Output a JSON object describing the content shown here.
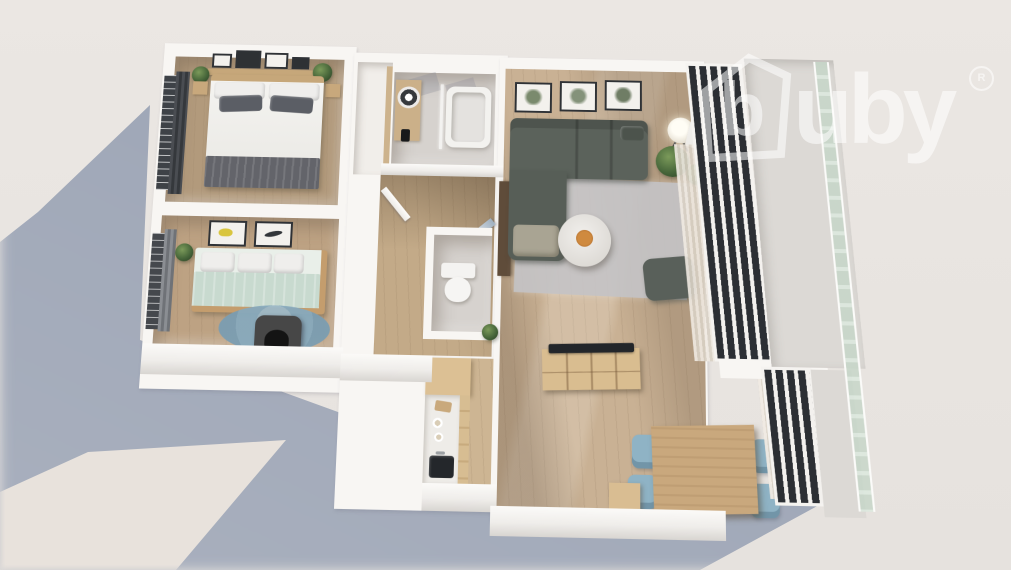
{
  "watermark": {
    "brand": "buby",
    "logomark_letter": "b",
    "wordmark": "uby",
    "registered_symbol": "R"
  },
  "scene": {
    "type": "3d-floor-plan-render",
    "view": "top-down bird's eye view",
    "property": "two-bedroom apartment with open-plan living room, kitchen and dining area, bathroom, separate WC, hallway and balcony with glass balustrade"
  },
  "rooms": [
    {
      "name": "master-bedroom",
      "furniture": [
        "double bed with white duvet and dark grey pillows",
        "dark grey folded blanket",
        "wooden headboard shelf with framed pictures",
        "two wooden nightstands",
        "potted plants",
        "window with dark curtain and blinds"
      ]
    },
    {
      "name": "second-bedroom",
      "furniture": [
        "daybed with sage green bedding and white pillows",
        "two framed wall prints",
        "round blue rug",
        "dark pet house",
        "potted plant",
        "window with curtain"
      ]
    },
    {
      "name": "bathroom",
      "furniture": [
        "top-view washing machine on wooden counter",
        "detergent bottle",
        "bathtub with glass screen",
        "skylight light patches"
      ]
    },
    {
      "name": "hallway",
      "furniture": [
        "wooden plank flooring",
        "open white door",
        "open glass door to living room"
      ]
    },
    {
      "name": "wc",
      "furniture": [
        "toilet",
        "potted plant"
      ]
    },
    {
      "name": "living-room",
      "furniture": [
        "L-shaped grey-green corner sofa",
        "three botanical framed prints",
        "floor lamp",
        "potted plants",
        "round white coffee table with orange flowers",
        "grey area rug",
        "dark ottoman",
        "wooden TV sideboard with flat TV",
        "tall dark cabinet",
        "open balcony door"
      ]
    },
    {
      "name": "kitchen",
      "furniture": [
        "white countertop with dark sink",
        "wooden cabinet fronts",
        "tall wooden cabinet",
        "plates and cutting board"
      ]
    },
    {
      "name": "dining-area",
      "furniture": [
        "wooden dining table",
        "four light blue chairs",
        "small wooden side table",
        "window with sheer curtains"
      ]
    },
    {
      "name": "balcony",
      "furniture": [
        "floor-to-ceiling window wall with dark glass panes",
        "glass balustrade",
        "light balcony floor"
      ]
    }
  ],
  "colors": {
    "background": "#eae6e2",
    "cast_shadow": "#9aa3b4",
    "sunlit_patch": "#e8e2dc",
    "walls": "#f8f6f3",
    "wood_floor": "#c9b194",
    "bedroom_carpet": "#b29a7c",
    "sofa": "#5b625b",
    "rug_grey": "#c5c4c6",
    "rug_blue": "#8aabbd",
    "chair_blue": "#8fb3c5",
    "wood_furniture": "#d9bd90",
    "window_glass": "#2c2f34",
    "balustrade_glass": "#c6d6c8",
    "logo_white": "#ffffff"
  }
}
